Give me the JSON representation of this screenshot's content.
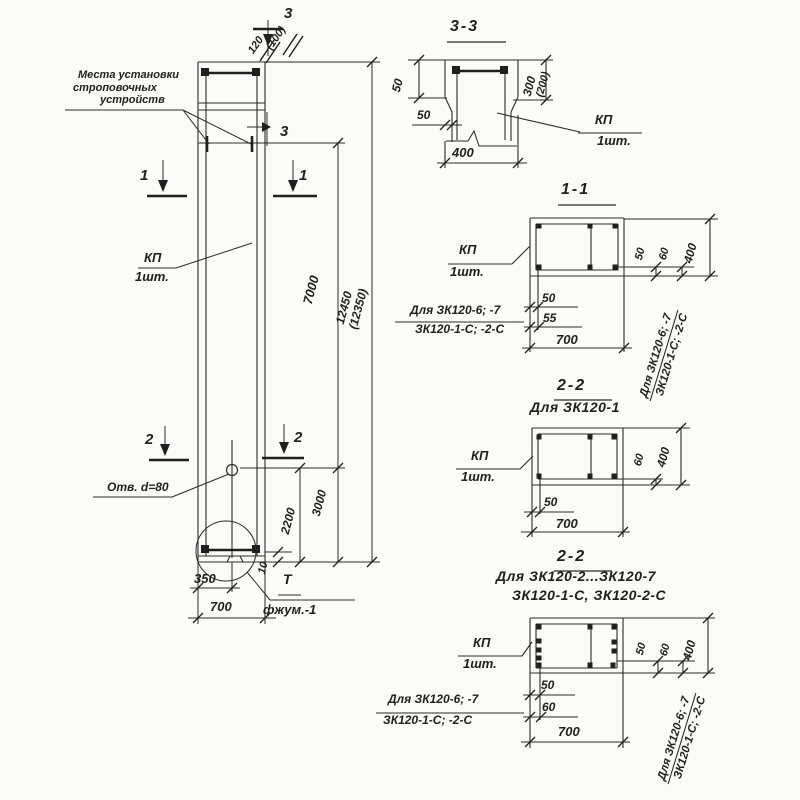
{
  "colors": {
    "ink": "#1f1f1f",
    "paper": "#fbfbf9"
  },
  "labels": {
    "sling1": "Места установки",
    "sling2": "строповочных",
    "sling3": "устройств",
    "kp": "КП",
    "qty": "1шт.",
    "hole": "Отв. d=80",
    "detail_t": "Т",
    "detail_name": "фжум.-1"
  },
  "marks": {
    "m1": "1",
    "m2": "2",
    "m3": "3"
  },
  "dims": {
    "d10": "10",
    "d50": "50",
    "d55": "55",
    "d60": "60",
    "d100": "(100)",
    "d120": "120",
    "d200": "(200)",
    "d300": "300",
    "d350": "350",
    "d400": "400",
    "d700": "700",
    "d2200": "2200",
    "d3000": "3000",
    "d7000": "7000",
    "d12450": "12450",
    "d12350": "(12350)"
  },
  "sections": {
    "s33": {
      "title": "3-3"
    },
    "s11": {
      "title": "1-1"
    },
    "s22a": {
      "title": "2-2",
      "subtitle": "Для ЗК120-1"
    },
    "s22b": {
      "title": "2-2",
      "subtitle1": "Для ЗК120-2...ЗК120-7",
      "subtitle2": "ЗК120-1-С, ЗК120-2-С"
    }
  },
  "notes": {
    "line1": "Для ЗК120-6; -7",
    "line2": "ЗК120-1-С; -2-С"
  }
}
